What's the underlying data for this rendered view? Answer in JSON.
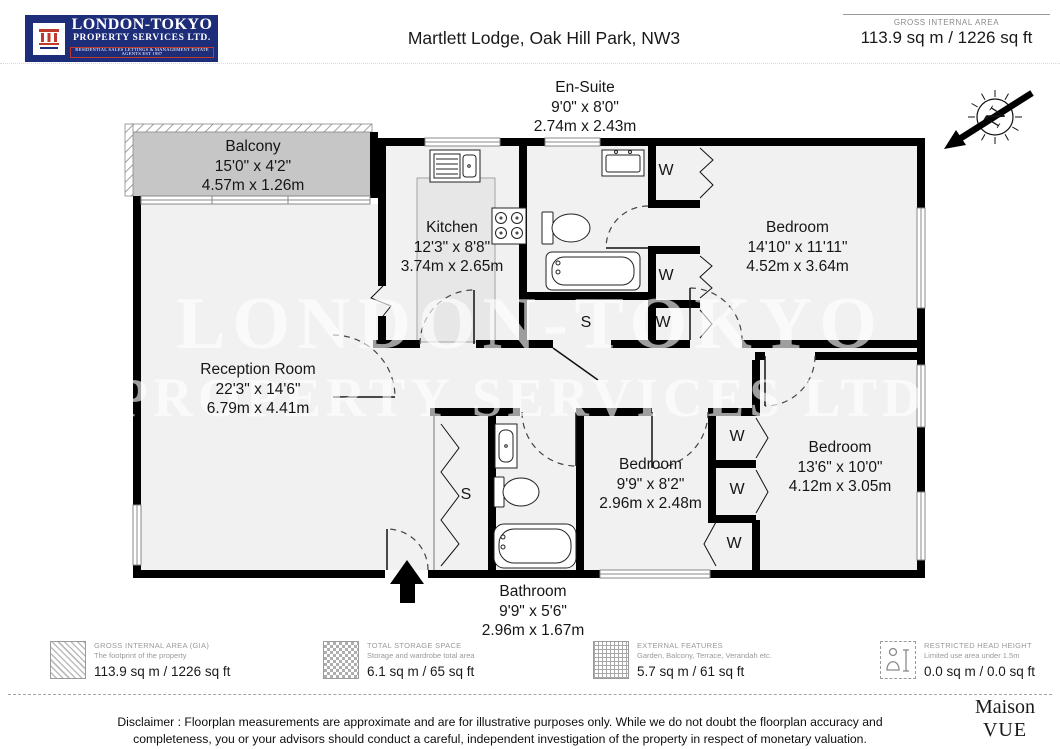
{
  "header": {
    "logo_name": "LONDON-TOKYO",
    "logo_sub": "PROPERTY SERVICES LTD.",
    "logo_tagline": "RESIDENTIAL SALES  LETTINGS & MANAGEMENT ESTATE AGENTS EST 1987",
    "title": "Martlett Lodge, Oak Hill Park, NW3",
    "gia_label": "GROSS INTERNAL AREA",
    "gia_value": "113.9 sq m / 1226 sq ft"
  },
  "compass": {
    "letter": "N"
  },
  "rooms": {
    "ensuite": {
      "name": "En-Suite",
      "imperial": "9'0\" x 8'0\"",
      "metric": "2.74m x 2.43m"
    },
    "balcony": {
      "name": "Balcony",
      "imperial": "15'0\" x 4'2\"",
      "metric": "4.57m x 1.26m"
    },
    "kitchen": {
      "name": "Kitchen",
      "imperial": "12'3\" x 8'8\"",
      "metric": "3.74m x 2.65m"
    },
    "bedroom1": {
      "name": "Bedroom",
      "imperial": "14'10\" x 11'11\"",
      "metric": "4.52m x 3.64m"
    },
    "reception": {
      "name": "Reception Room",
      "imperial": "22'3\" x 14'6\"",
      "metric": "6.79m x 4.41m"
    },
    "bedroom2": {
      "name": "Bedroom",
      "imperial": "9'9\" x 8'2\"",
      "metric": "2.96m x 2.48m"
    },
    "bedroom3": {
      "name": "Bedroom",
      "imperial": "13'6\" x 10'0\"",
      "metric": "4.12m x 3.05m"
    },
    "bathroom": {
      "name": "Bathroom",
      "imperial": "9'9\" x 5'6\"",
      "metric": "2.96m x 1.67m"
    }
  },
  "plan_labels": {
    "wardrobe": "W",
    "storage": "S"
  },
  "watermark": {
    "line1": "LONDON-TOKYO",
    "line2": "PROPERTY SERVICES LTD."
  },
  "legend": {
    "items": [
      {
        "label": "GROSS INTERNAL AREA (GIA)",
        "sublabel": "The footprint of the property",
        "value": "113.9 sq m / 1226 sq ft"
      },
      {
        "label": "TOTAL STORAGE SPACE",
        "sublabel": "Storage and wardrobe total area",
        "value": "6.1 sq m / 65 sq ft"
      },
      {
        "label": "EXTERNAL FEATURES",
        "sublabel": "Garden, Balcony, Terrace, Verandah etc.",
        "value": "5.7 sq m / 61 sq ft"
      },
      {
        "label": "RESTRICTED HEAD HEIGHT",
        "sublabel": "Limited use area under 1.5m",
        "value": "0.0 sq m / 0.0 sq ft"
      }
    ]
  },
  "footer": {
    "disclaimer": "Disclaimer : Floorplan measurements are approximate and are for illustrative purposes only. While we do not doubt the floorplan accuracy and completeness, you or your advisors should conduct a careful, independent investigation of the property in respect of monetary valuation.",
    "brand_line1": "Maison",
    "brand_line2": "VUE"
  },
  "colors": {
    "logo_blue": "#1d2d7a",
    "logo_red": "#c0392b",
    "wall": "#000000",
    "room_fill": "#f1f1f1",
    "balcony_fill": "#c6c6c6"
  }
}
